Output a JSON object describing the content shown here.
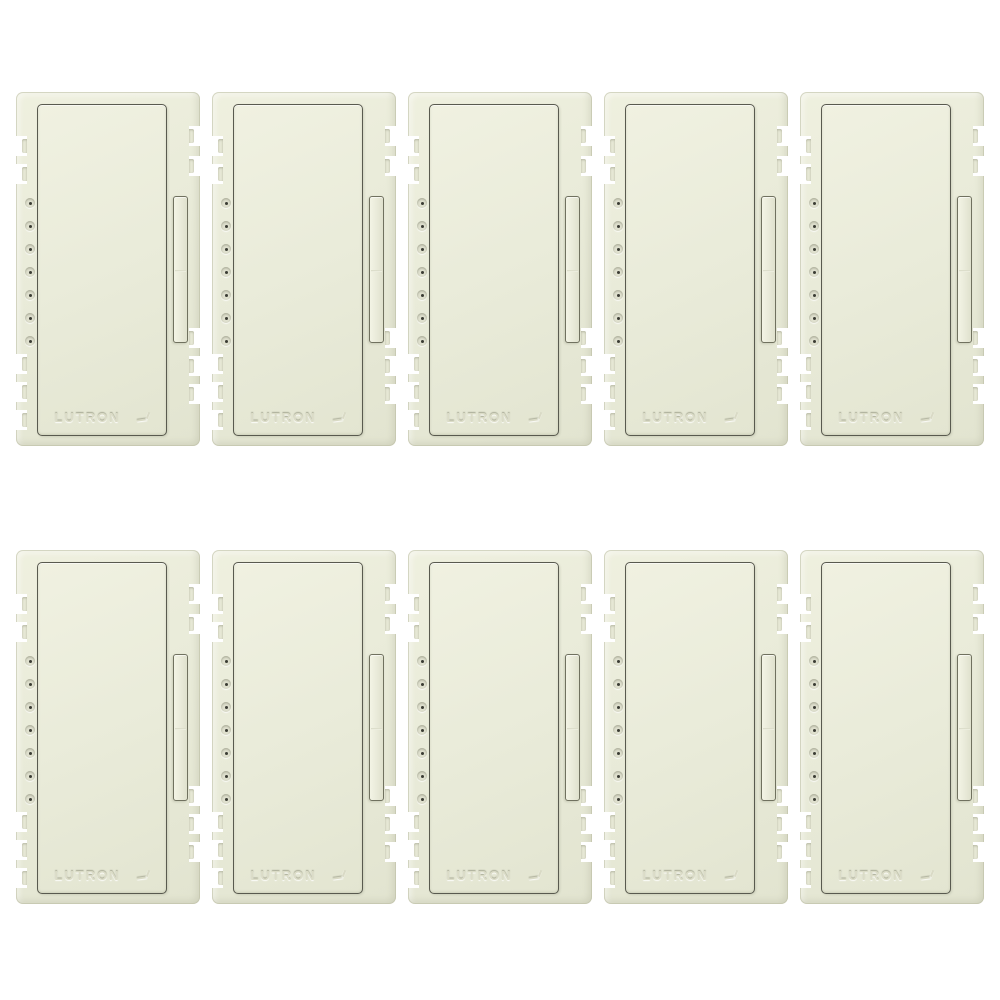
{
  "scene": {
    "type": "product-photo",
    "background_color": "#ffffff",
    "description": "Ten identical almond/biscuit colored dimmer switch color-change kits arranged in a 2 by 5 grid on a white background"
  },
  "product": {
    "brand_label": "LUTRON",
    "body_color": "#e9ebd9",
    "outline_color": "#595a4f",
    "unit_count": 10,
    "indicator_dots_per_unit": 7,
    "grid_rows": 2,
    "grid_columns": 5,
    "features": {
      "rocker_button": true,
      "dimmer_slider": true,
      "breakaway_side_tabs": true,
      "embossed_logo": true
    }
  },
  "units": [
    {
      "position": "row1-col1"
    },
    {
      "position": "row1-col2"
    },
    {
      "position": "row1-col3"
    },
    {
      "position": "row1-col4"
    },
    {
      "position": "row1-col5"
    },
    {
      "position": "row2-col1"
    },
    {
      "position": "row2-col2"
    },
    {
      "position": "row2-col3"
    },
    {
      "position": "row2-col4"
    },
    {
      "position": "row2-col5"
    }
  ]
}
